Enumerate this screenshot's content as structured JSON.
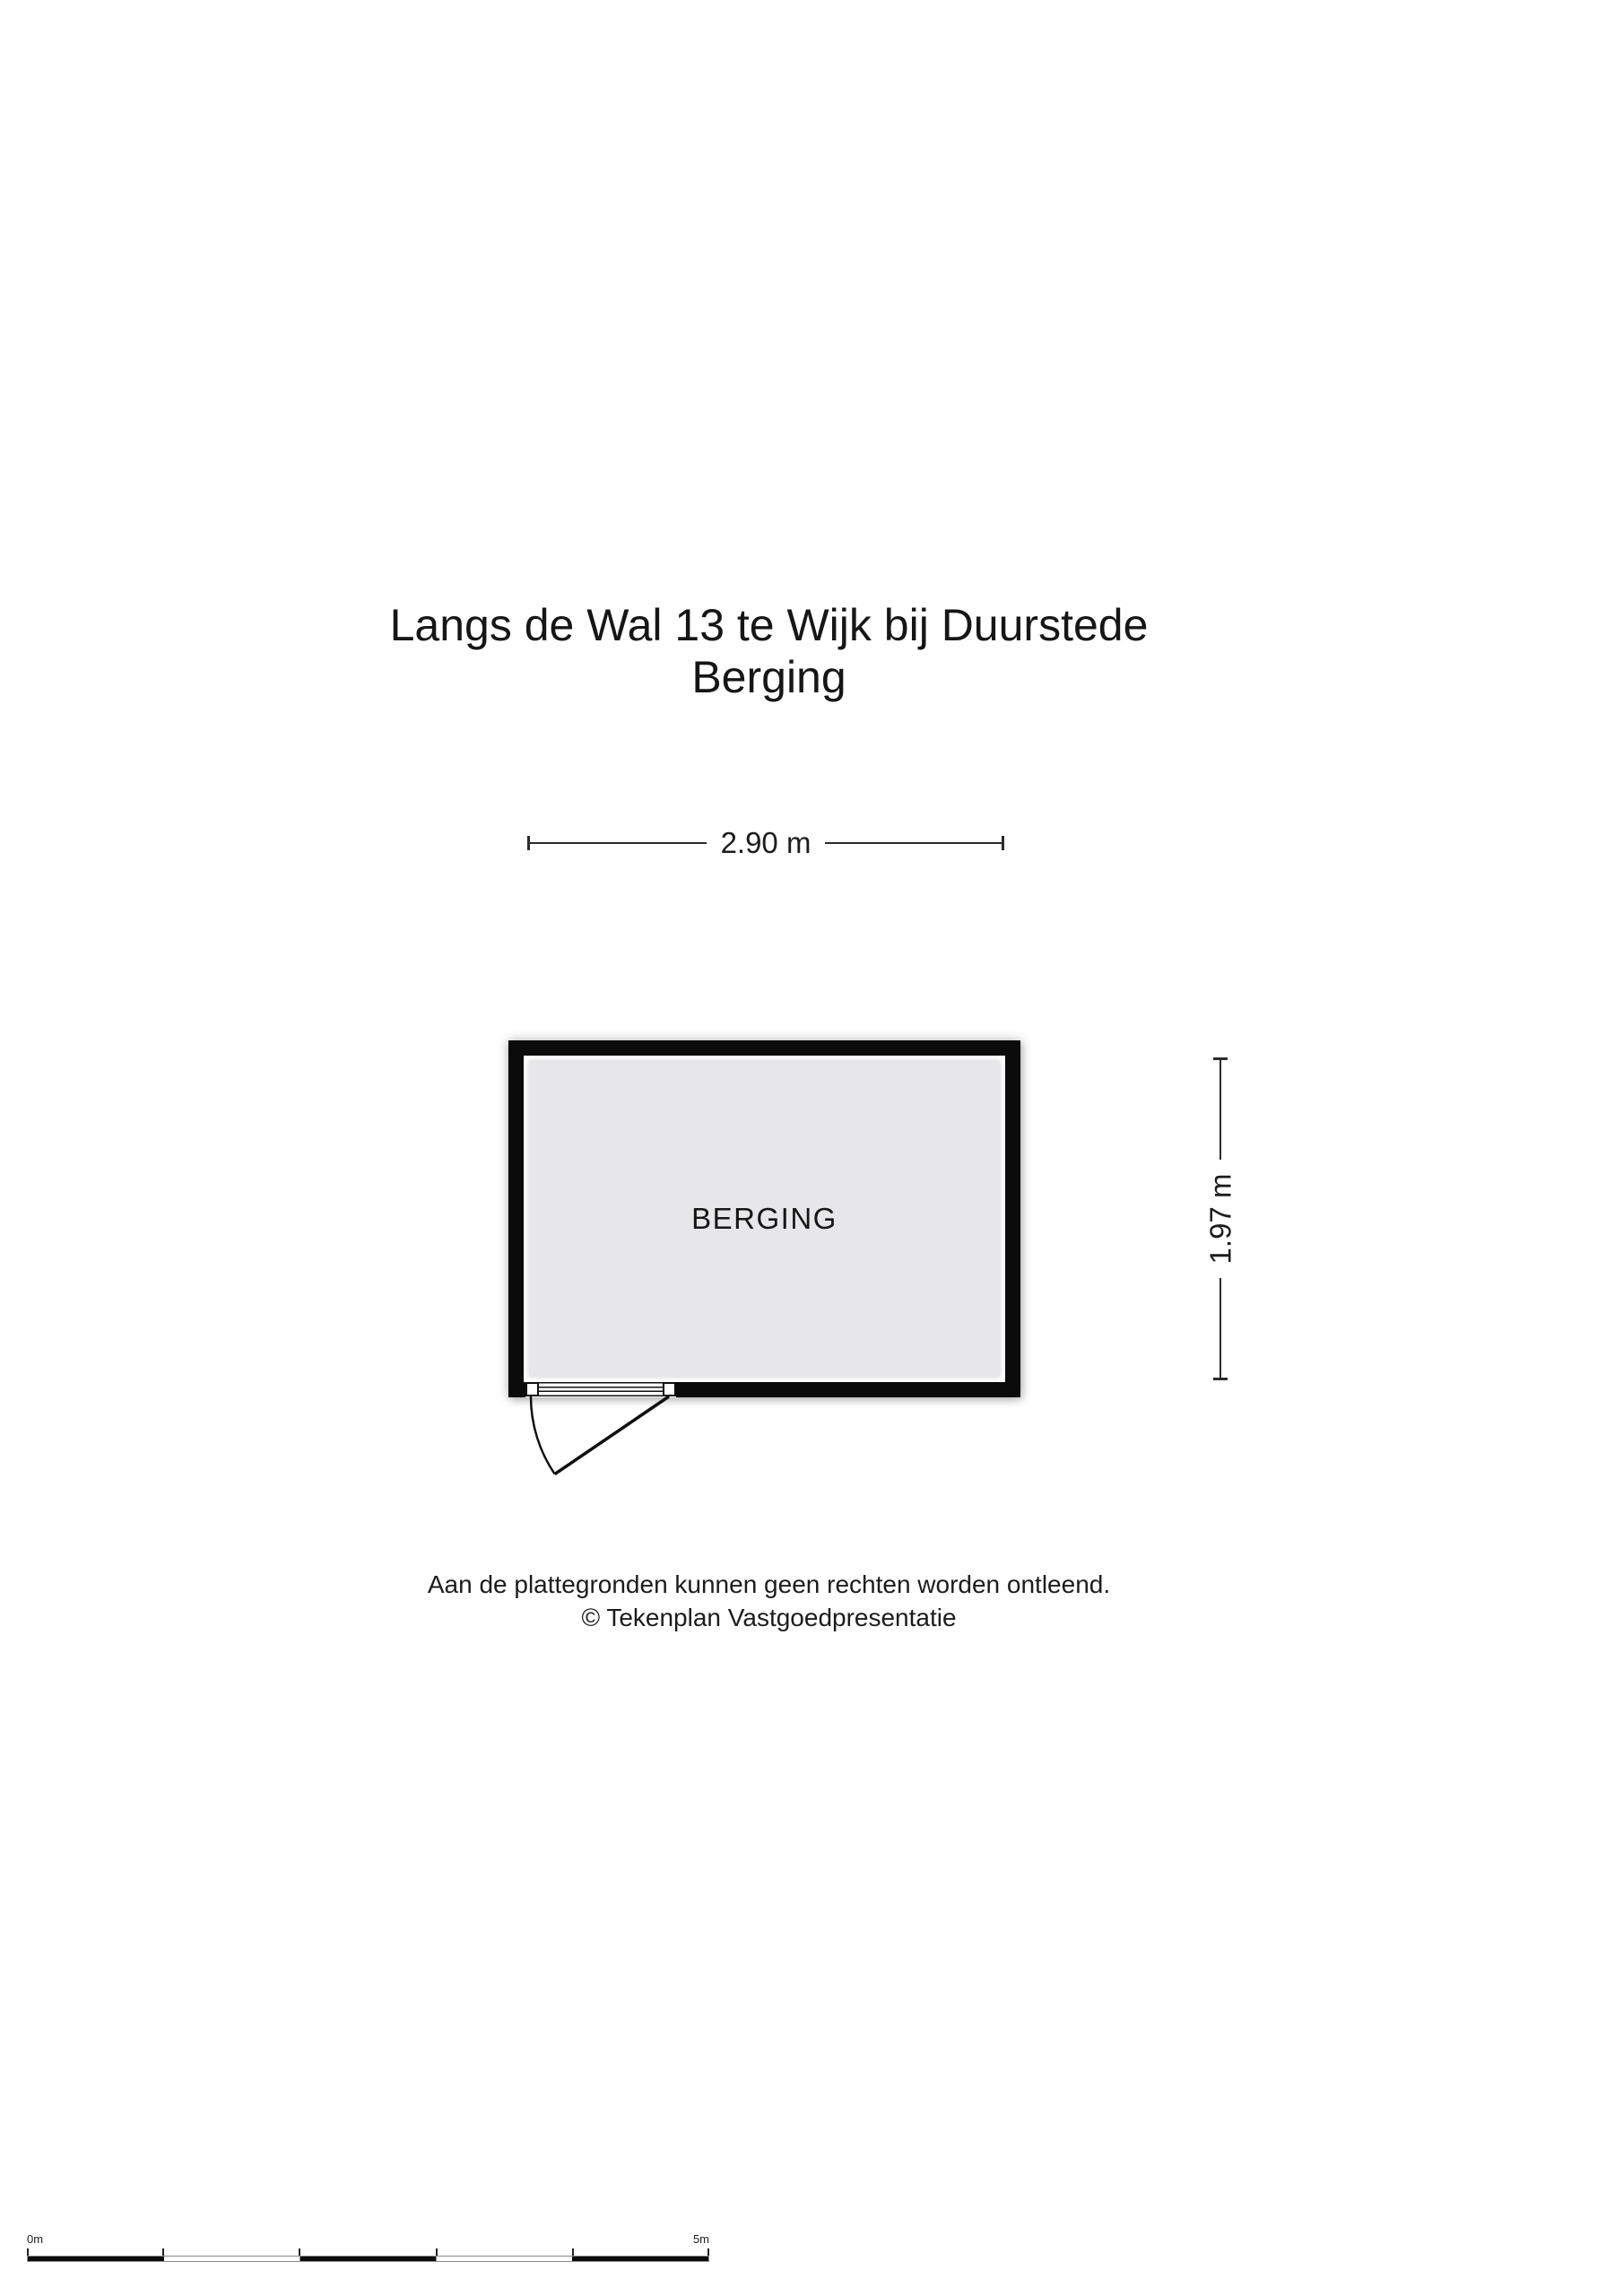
{
  "title": {
    "line1": "Langs de Wal 13 te Wijk bij Duurstede",
    "line2": "Berging"
  },
  "floorplan": {
    "room_label": "BERGING",
    "width_dim": "2.90 m",
    "height_dim": "1.97 m",
    "wall_color": "#0b0b0b",
    "floor_color": "#e7e7e9"
  },
  "footer": {
    "line1": "Aan de plattegronden kunnen geen rechten worden ontleend.",
    "line2": "© Tekenplan Vastgoedpresentatie"
  },
  "scale_bar": {
    "start_label": "0m",
    "end_label": "5m"
  }
}
